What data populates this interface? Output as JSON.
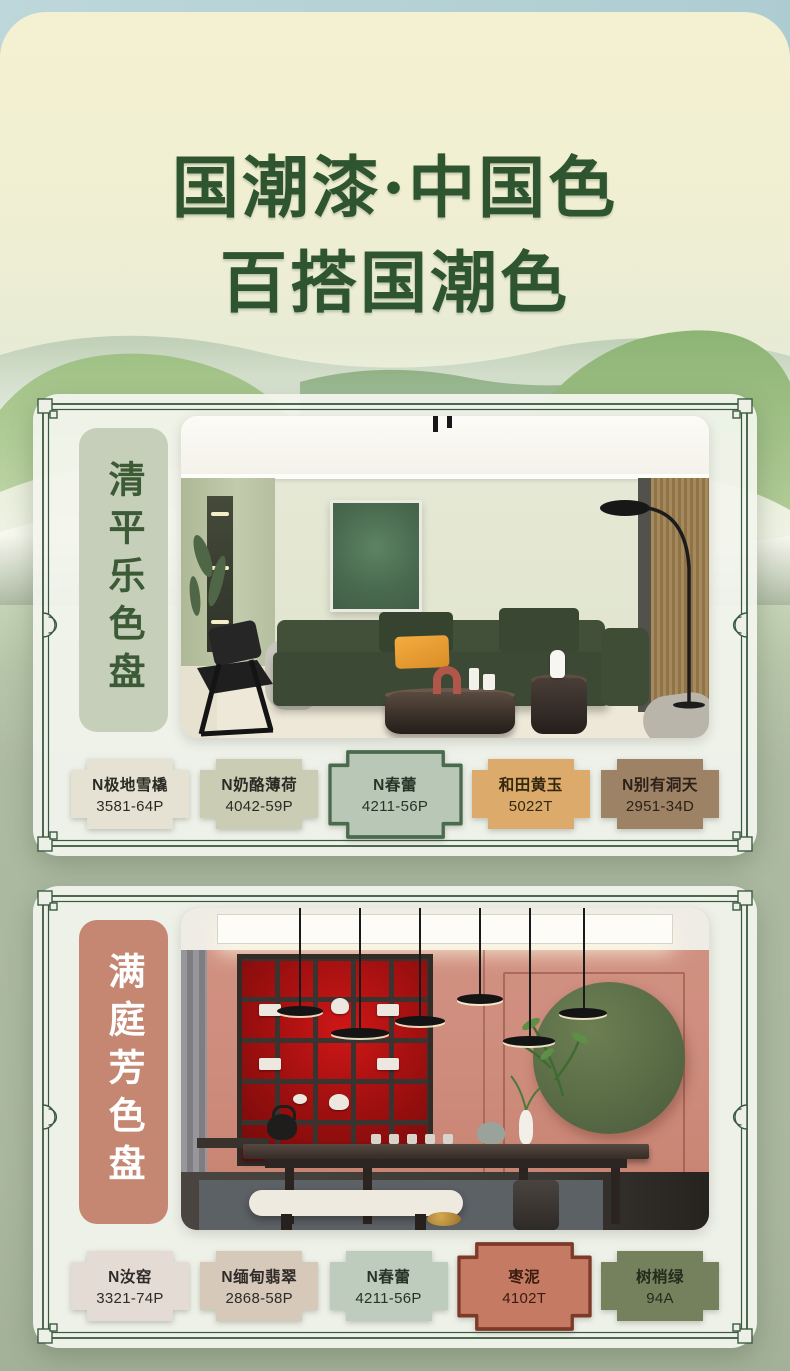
{
  "poster": {
    "title": {
      "line1": "国潮漆·中国色",
      "line2": "百搭国潮色",
      "color": "#2e5430"
    },
    "colors": {
      "sky": "#b7d3d8",
      "paper_cream": "#f3f0d0",
      "sage_background": "#adbaa2",
      "frame_green": "#3a5a40",
      "card_background": "#f2f4ec"
    },
    "palettes": [
      {
        "name": "清平乐色盘",
        "label_bg": "#c6cfba",
        "label_color": "#3b5a35",
        "swatches": [
          {
            "name": "N极地雪橇",
            "code": "3581-64P",
            "color": "#e6e2d3",
            "text": "#2b2b26"
          },
          {
            "name": "N奶酪薄荷",
            "code": "4042-59P",
            "color": "#cbccb4",
            "text": "#2b2b26"
          },
          {
            "name": "N春蕾",
            "code": "4211-56P",
            "color": "#b9c7b7",
            "text": "#273427",
            "border": "#4a6a4e",
            "featured": true
          },
          {
            "name": "和田黄玉",
            "code": "5022T",
            "color": "#dcaa6b",
            "text": "#33270f"
          },
          {
            "name": "N别有洞天",
            "code": "2951-34D",
            "color": "#9d8265",
            "text": "#2a2118"
          }
        ]
      },
      {
        "name": "满庭芳色盘",
        "label_bg": "#c58672",
        "label_color": "#ffffff",
        "swatches": [
          {
            "name": "N汝窑",
            "code": "3321-74P",
            "color": "#e4dbd5",
            "text": "#2f2b28"
          },
          {
            "name": "N缅甸翡翠",
            "code": "2868-58P",
            "color": "#d6c9ba",
            "text": "#2f2b28"
          },
          {
            "name": "N春蕾",
            "code": "4211-56P",
            "color": "#bdccbc",
            "text": "#283227"
          },
          {
            "name": "枣泥",
            "code": "4102T",
            "color": "#c57b63",
            "text": "#3a1b10",
            "border": "#7e3a28",
            "featured": true
          },
          {
            "name": "树梢绿",
            "code": "94A",
            "color": "#75815d",
            "text": "#232b1b"
          }
        ]
      }
    ]
  }
}
